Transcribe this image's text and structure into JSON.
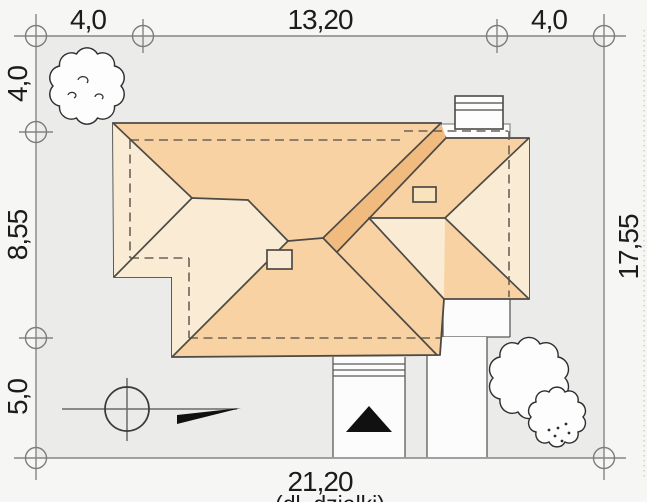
{
  "drawing_kind": "house roof site plan with plot dimensions",
  "dimensions": {
    "top": [
      "4,0",
      "13,20",
      "4,0"
    ],
    "left": [
      "4,0",
      "8,55",
      "5,0"
    ],
    "right": "17,55",
    "bottom": "21,20",
    "bottom_caption_cutoff": "(dł. działki)"
  },
  "colors": {
    "plot_fill": "#ebebea",
    "page_background": "#f6f6f5",
    "roof_main": "#f8d2a2",
    "roof_light": "#faecd4",
    "roof_dark_band": "#f1bb80",
    "roof_outline": "#4d4a45",
    "wall_dash": "#6a6258",
    "dimension_line": "#858585",
    "paving_white": "#fcfcfc",
    "arrow_black": "#111111"
  },
  "symbols": {
    "survey_markers": 8,
    "trees": [
      "tree-top-left",
      "tree-bottom-right-large",
      "bush-bottom-right-small"
    ],
    "compass": "survey point with north arrow",
    "entrance_arrow": "black triangle at entrance walkway",
    "chimneys": 2,
    "roof_windows": 1
  }
}
